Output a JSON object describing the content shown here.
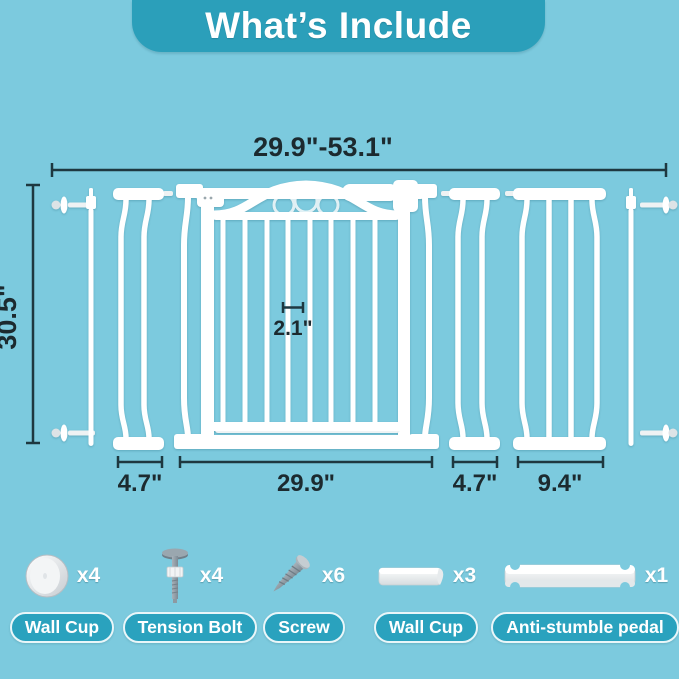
{
  "colors": {
    "background": "#7ccade",
    "header_teal": "#2b9fba",
    "pill_teal": "#2aa2be",
    "dimension_line": "#1e3840",
    "part_white": "#ffffff"
  },
  "header": {
    "title": "What’s Include"
  },
  "dimensions": {
    "total_width_range": "29.9\"-53.1\"",
    "gate_height": "30.5\"",
    "bar_gap": "2.1\"",
    "extension_left": "4.7\"",
    "gate_width": "29.9\"",
    "extension_right_small": "4.7\"",
    "extension_right_large": "9.4\""
  },
  "parts": [
    {
      "name": "Wall Cup",
      "count": "x4",
      "icon": "wall-cup-round-icon"
    },
    {
      "name": "Tension Bolt",
      "count": "x4",
      "icon": "tension-bolt-icon"
    },
    {
      "name": "Screw",
      "count": "x6",
      "icon": "screw-icon"
    },
    {
      "name": "Wall Cup",
      "count": "x3",
      "icon": "wall-cup-channel-icon"
    },
    {
      "name": "Anti-stumble pedal",
      "count": "x1",
      "icon": "anti-stumble-pedal-icon"
    }
  ]
}
